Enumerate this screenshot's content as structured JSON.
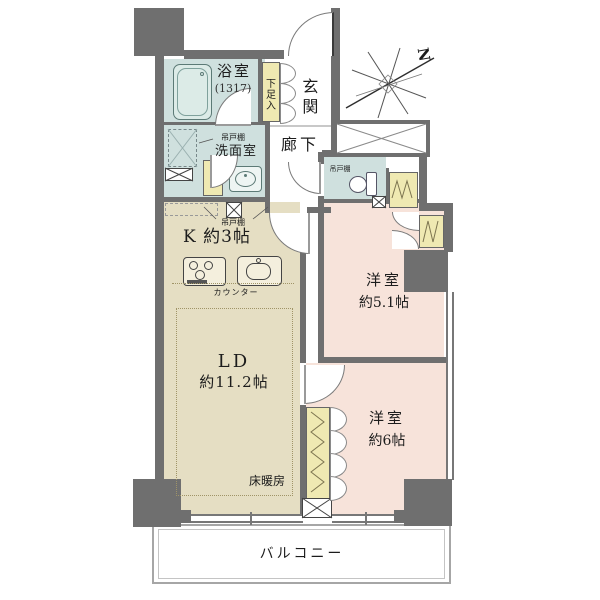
{
  "rooms": {
    "bathroom": {
      "name": "浴室",
      "size_code": "(1317)"
    },
    "shoe_box": {
      "name": "下足入"
    },
    "entrance": {
      "name": "玄関"
    },
    "hallway": {
      "name": "廊下"
    },
    "washroom": {
      "name": "洗面室"
    },
    "kitchen": {
      "name": "K 約3帖",
      "counter": "カウンター"
    },
    "living_dining": {
      "name": "LD",
      "size": "約11.2帖",
      "floor_heating": "床暖房"
    },
    "bedroom_1": {
      "name": "洋室",
      "size": "約5.1帖"
    },
    "bedroom_2": {
      "name": "洋室",
      "size": "約6帖"
    },
    "balcony": {
      "name": "バルコニー"
    }
  },
  "labels": {
    "hanging_cupboard": "吊戸棚"
  },
  "compass": {
    "north": "N"
  },
  "colors": {
    "wall": "#6f6f6f",
    "wet_room": "#cfe0de",
    "wood_floor": "#e5dec3",
    "bedroom": "#f7e3da",
    "closet": "#efe9b2"
  }
}
